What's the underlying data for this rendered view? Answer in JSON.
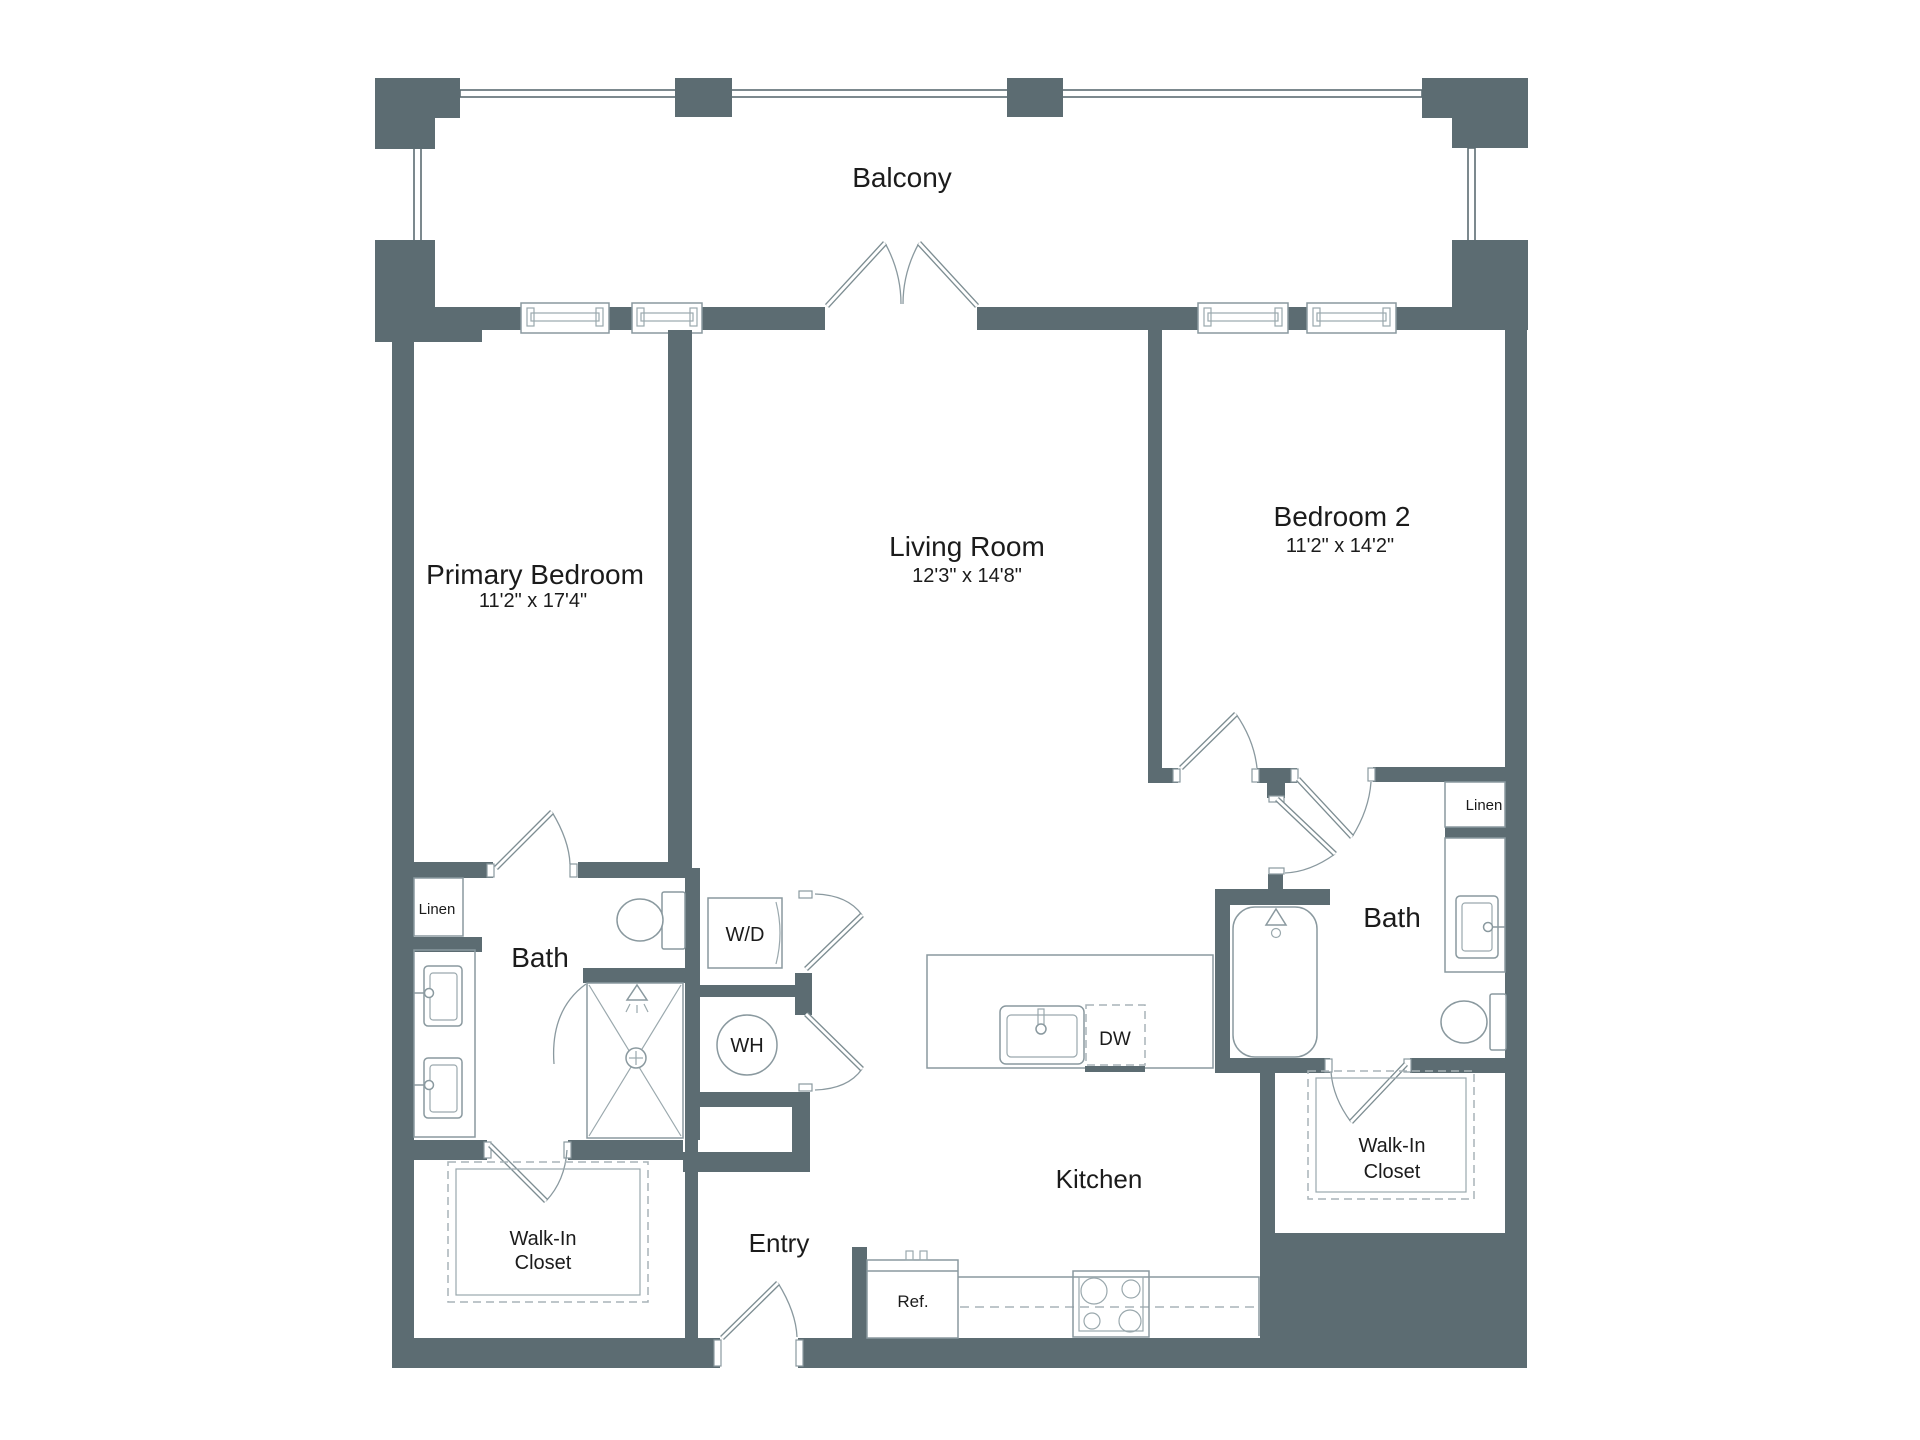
{
  "colors": {
    "wall": "#5C6C72",
    "fixture_line": "#8A999F",
    "dashed_line": "#A9B4B8",
    "text": "#1B1B1B",
    "background": "#FFFFFF"
  },
  "rooms": {
    "balcony": {
      "label": "Balcony"
    },
    "primary_bedroom": {
      "label": "Primary Bedroom",
      "dims": "11'2\" x 17'4\""
    },
    "living_room": {
      "label": "Living Room",
      "dims": "12'3\" x 14'8\""
    },
    "bedroom_2": {
      "label": "Bedroom 2",
      "dims": "11'2\" x 14'2\""
    },
    "primary_bath": {
      "label": "Bath"
    },
    "bath_2": {
      "label": "Bath"
    },
    "kitchen": {
      "label": "Kitchen"
    },
    "entry": {
      "label": "Entry"
    },
    "walk_in_closet_1": {
      "line1": "Walk-In",
      "line2": "Closet"
    },
    "walk_in_closet_2": {
      "line1": "Walk-In",
      "line2": "Closet"
    },
    "linen_1": {
      "label": "Linen"
    },
    "linen_2": {
      "label": "Linen"
    }
  },
  "fixtures": {
    "washer_dryer": {
      "label": "W/D"
    },
    "water_heater": {
      "label": "WH"
    },
    "dishwasher": {
      "label": "DW"
    },
    "refrigerator": {
      "label": "Ref."
    }
  }
}
